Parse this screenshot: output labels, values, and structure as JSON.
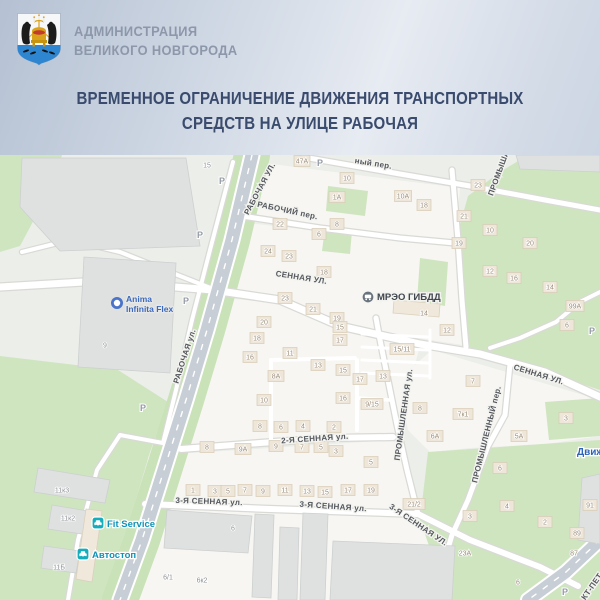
{
  "header": {
    "org_line1": "АДМИНИСТРАЦИЯ",
    "org_line2": "ВЕЛИКОГО НОВГОРОДА",
    "logo": "novgorod-coat-of-arms"
  },
  "title": {
    "line1": "ВРЕМЕННОЕ ОГРАНИЧЕНИЕ ДВИЖЕНИЯ ТРАНСПОРТНЫХ",
    "line2": "СРЕДСТВ НА УЛИЦЕ РАБОЧАЯ"
  },
  "map": {
    "colors": {
      "base": "#eceeea",
      "block": "#f7f6f2",
      "green": "#cfe5c0",
      "band": "#c9e2b7",
      "casing": "#d9dad6",
      "major": "#c7ced6",
      "bgray": "#dfe1e0",
      "bgstroke": "#ccd0cf",
      "bbeige": "#efe8db",
      "bbstroke": "#dbd0bd",
      "house": "#eee6d8",
      "housestroke": "#d8cbb6",
      "teal": "#15adbc",
      "accent_blue": "#2f63b5"
    },
    "blocks": [
      "240,160 460,188 455,243 238,218",
      "238,222 455,246 463,345 340,326 280,300 218,295",
      "216,298 280,302 340,328 420,346 395,438 183,450",
      "148,456 393,440 418,515 145,505",
      "432,350 600,400 600,436 546,444 470,448 430,452 408,430 398,380",
      "150,455 400,442 420,520 448,552 450,600 105,600"
    ],
    "greens": [
      "0,155 62,155 54,182 20,246 0,252",
      "528,155 600,155 600,390 552,374 505,360 468,348 460,300 455,243 468,196 500,172",
      "328,186 368,191 365,216 326,211",
      "325,228 352,231 350,254 322,251",
      "420,258 448,262 445,306 417,301",
      "0,356 118,370 168,402 150,452 106,600 0,600",
      "428,452 600,440 600,600 448,600 420,520",
      "545,402 600,398 600,436 549,440"
    ],
    "band": "252,155 232,240 207,330 186,400 164,470 142,540 120,600",
    "major": "252,155 232,240 207,330 186,400 164,470 142,540 120,600",
    "stp": "600,540 566,572 528,600",
    "roads": [
      {
        "p": "0,287 100,281 213,290 280,300 340,326 420,344 480,354 545,372 600,397",
        "w": 7,
        "t": "m"
      },
      {
        "p": "242,216 320,228 400,238 455,243",
        "w": 5,
        "t": "m"
      },
      {
        "p": "303,157 400,174 470,186 545,200 600,210",
        "w": 5,
        "t": "m"
      },
      {
        "p": "452,170 458,240 462,300 466,347",
        "w": 5,
        "t": "m"
      },
      {
        "p": "181,449 260,443 330,438 393,437",
        "w": 6,
        "t": "m"
      },
      {
        "p": "145,504 270,509 418,514 470,540 540,567 578,586",
        "w": 6,
        "t": "m"
      },
      {
        "p": "376,318 380,340 388,380 397,425 407,470 418,514",
        "w": 5,
        "t": "m"
      },
      {
        "p": "510,364 505,415 488,446 468,500 452,535 446,555",
        "w": 5,
        "t": "m"
      },
      {
        "p": "233,162 210,250 192,320 176,390 163,443",
        "w": 4,
        "t": "m"
      },
      {
        "p": "163,443 120,435 97,470 78,540 68,600",
        "w": 4,
        "t": "m"
      },
      {
        "p": "22,252 70,240 120,252 170,272 213,289",
        "w": 4,
        "t": "m"
      },
      {
        "p": "600,292 580,302 556,322 520,338 490,348",
        "w": 4,
        "t": "m"
      },
      {
        "p": "271,360 355,358",
        "w": 4,
        "t": "l"
      },
      {
        "p": "271,360 271,445",
        "w": 4,
        "t": "l"
      },
      {
        "p": "357,360 357,430",
        "w": 4,
        "t": "l"
      },
      {
        "p": "357,398 390,400",
        "w": 3.5,
        "t": "l"
      },
      {
        "p": "362,334 428,337",
        "w": 3,
        "t": "l"
      },
      {
        "p": "362,347 428,350",
        "w": 3,
        "t": "l"
      },
      {
        "p": "362,360 428,363",
        "w": 3,
        "t": "l"
      },
      {
        "p": "362,373 428,376",
        "w": 3,
        "t": "l"
      },
      {
        "p": "430,330 430,378",
        "w": 3,
        "t": "l"
      }
    ],
    "buildings": [
      {
        "p": "22,158 186,158 200,246 60,251 20,207",
        "f": "gr"
      },
      {
        "p": "84,257 176,263 170,373 78,367",
        "f": "gr"
      },
      {
        "p": "167,510 252,516 248,553 164,548",
        "f": "gr"
      },
      {
        "p": "255,514 274,515 271,598 252,597",
        "f": "gr"
      },
      {
        "p": "280,527 299,528 297,600 278,600",
        "f": "gr"
      },
      {
        "p": "303,513 328,514 325,600 300,600",
        "f": "gr"
      },
      {
        "p": "333,541 455,546 452,600 330,600",
        "f": "gr"
      },
      {
        "p": "38,468 110,480 105,503 34,492",
        "f": "gr"
      },
      {
        "p": "52,505 100,513 96,536 48,529",
        "f": "gr"
      },
      {
        "p": "44,546 80,551 76,573 41,568",
        "f": "gr"
      },
      {
        "p": "516,155 600,155 600,172 520,169",
        "f": "gr"
      },
      {
        "p": "582,478 600,474 600,544 578,540",
        "f": "gr"
      },
      {
        "p": "86,509 102,511 92,582 76,579",
        "f": "be"
      },
      {
        "p": "394,300 440,304 439,317 393,313",
        "f": "be"
      }
    ],
    "houses": [
      {
        "x": 207,
        "y": 165,
        "n": "15",
        "r": 0,
        "c": "b"
      },
      {
        "x": 302,
        "y": 161,
        "n": "47А",
        "w": 16
      },
      {
        "x": 347,
        "y": 178,
        "n": "10"
      },
      {
        "x": 337,
        "y": 197,
        "n": "1А",
        "w": 16
      },
      {
        "x": 403,
        "y": 196,
        "n": "10А",
        "w": 17
      },
      {
        "x": 424,
        "y": 205,
        "n": "18"
      },
      {
        "x": 478,
        "y": 185,
        "n": "23"
      },
      {
        "x": 464,
        "y": 216,
        "n": "21"
      },
      {
        "x": 490,
        "y": 230,
        "n": "10"
      },
      {
        "x": 459,
        "y": 243,
        "n": "19"
      },
      {
        "x": 530,
        "y": 243,
        "n": "20"
      },
      {
        "x": 490,
        "y": 271,
        "n": "12"
      },
      {
        "x": 514,
        "y": 278,
        "n": "16"
      },
      {
        "x": 550,
        "y": 287,
        "n": "14"
      },
      {
        "x": 575,
        "y": 306,
        "n": "99А",
        "w": 18
      },
      {
        "x": 567,
        "y": 325,
        "n": "6"
      },
      {
        "x": 280,
        "y": 224,
        "n": "22"
      },
      {
        "x": 337,
        "y": 224,
        "n": "8"
      },
      {
        "x": 319,
        "y": 234,
        "n": "6"
      },
      {
        "x": 268,
        "y": 251,
        "n": "24"
      },
      {
        "x": 289,
        "y": 256,
        "n": "23"
      },
      {
        "x": 324,
        "y": 272,
        "n": "18"
      },
      {
        "x": 424,
        "y": 313,
        "n": "14",
        "r": 0
      },
      {
        "x": 447,
        "y": 330,
        "n": "12"
      },
      {
        "x": 402,
        "y": 349,
        "n": "15/11",
        "w": 24
      },
      {
        "x": 285,
        "y": 298,
        "n": "23"
      },
      {
        "x": 313,
        "y": 309,
        "n": "21"
      },
      {
        "x": 337,
        "y": 318,
        "n": "19"
      },
      {
        "x": 264,
        "y": 322,
        "n": "20"
      },
      {
        "x": 257,
        "y": 338,
        "n": "18"
      },
      {
        "x": 340,
        "y": 327,
        "n": "15"
      },
      {
        "x": 340,
        "y": 340,
        "n": "17"
      },
      {
        "x": 290,
        "y": 353,
        "n": "11"
      },
      {
        "x": 250,
        "y": 357,
        "n": "16"
      },
      {
        "x": 318,
        "y": 365,
        "n": "13"
      },
      {
        "x": 343,
        "y": 370,
        "n": "15"
      },
      {
        "x": 276,
        "y": 376,
        "n": "8А",
        "w": 16
      },
      {
        "x": 360,
        "y": 379,
        "n": "17"
      },
      {
        "x": 383,
        "y": 376,
        "n": "13"
      },
      {
        "x": 264,
        "y": 400,
        "n": "10"
      },
      {
        "x": 343,
        "y": 398,
        "n": "16"
      },
      {
        "x": 372,
        "y": 404,
        "n": "9/15",
        "w": 22
      },
      {
        "x": 260,
        "y": 426,
        "n": "8"
      },
      {
        "x": 281,
        "y": 427,
        "n": "6"
      },
      {
        "x": 303,
        "y": 426,
        "n": "4"
      },
      {
        "x": 334,
        "y": 427,
        "n": "2"
      },
      {
        "x": 207,
        "y": 447,
        "n": "8"
      },
      {
        "x": 243,
        "y": 449,
        "n": "9А",
        "w": 16
      },
      {
        "x": 276,
        "y": 446,
        "n": "9"
      },
      {
        "x": 302,
        "y": 447,
        "n": "7"
      },
      {
        "x": 321,
        "y": 447,
        "n": "5"
      },
      {
        "x": 336,
        "y": 451,
        "n": "3"
      },
      {
        "x": 371,
        "y": 462,
        "n": "5"
      },
      {
        "x": 193,
        "y": 490,
        "n": "1"
      },
      {
        "x": 215,
        "y": 491,
        "n": "3"
      },
      {
        "x": 228,
        "y": 491,
        "n": "5"
      },
      {
        "x": 245,
        "y": 490,
        "n": "7"
      },
      {
        "x": 263,
        "y": 491,
        "n": "9"
      },
      {
        "x": 285,
        "y": 490,
        "n": "11"
      },
      {
        "x": 307,
        "y": 491,
        "n": "13"
      },
      {
        "x": 325,
        "y": 492,
        "n": "15"
      },
      {
        "x": 348,
        "y": 490,
        "n": "17"
      },
      {
        "x": 371,
        "y": 490,
        "n": "19"
      },
      {
        "x": 414,
        "y": 504,
        "n": "21/2",
        "w": 22
      },
      {
        "x": 473,
        "y": 381,
        "n": "7"
      },
      {
        "x": 420,
        "y": 408,
        "n": "8"
      },
      {
        "x": 463,
        "y": 414,
        "n": "7к1",
        "w": 20
      },
      {
        "x": 435,
        "y": 436,
        "n": "6А",
        "w": 16
      },
      {
        "x": 519,
        "y": 436,
        "n": "5А",
        "w": 16
      },
      {
        "x": 566,
        "y": 418,
        "n": "3"
      },
      {
        "x": 500,
        "y": 468,
        "n": "6"
      },
      {
        "x": 507,
        "y": 506,
        "n": "4"
      },
      {
        "x": 545,
        "y": 522,
        "n": "2"
      },
      {
        "x": 470,
        "y": 516,
        "n": "3"
      },
      {
        "x": 590,
        "y": 505,
        "n": "91"
      },
      {
        "x": 577,
        "y": 533,
        "n": "89"
      },
      {
        "x": 574,
        "y": 553,
        "n": "87",
        "r": 0
      },
      {
        "x": 465,
        "y": 553,
        "n": "23А",
        "r": 0,
        "w": 18
      },
      {
        "x": 518,
        "y": 582,
        "n": "6",
        "r": 0
      },
      {
        "x": 62,
        "y": 490,
        "n": "11к3",
        "r": 0,
        "c": "b",
        "w": 22
      },
      {
        "x": 68,
        "y": 518,
        "n": "11к2",
        "r": 0,
        "c": "b",
        "w": 22
      },
      {
        "x": 59,
        "y": 567,
        "n": "11Б",
        "r": 0,
        "c": "b",
        "w": 20
      },
      {
        "x": 168,
        "y": 577,
        "n": "6/1",
        "r": 0,
        "c": "b"
      },
      {
        "x": 202,
        "y": 580,
        "n": "6к2",
        "r": 0,
        "c": "b",
        "w": 20
      },
      {
        "x": 233,
        "y": 528,
        "n": "6",
        "r": 0,
        "c": "b"
      },
      {
        "x": 105,
        "y": 345,
        "n": "9",
        "r": 0,
        "c": "b"
      }
    ],
    "parkings": [
      [
        222,
        181
      ],
      [
        200,
        235
      ],
      [
        186,
        301
      ],
      [
        143,
        408
      ],
      [
        320,
        163
      ],
      [
        592,
        331
      ],
      [
        565,
        592
      ]
    ],
    "labels": [
      {
        "x": 262,
        "y": 190,
        "t": "РАБОЧАЯ УЛ.",
        "r": -62
      },
      {
        "x": 187,
        "y": 357,
        "t": "РАБОЧАЯ ул.",
        "r": -72
      },
      {
        "x": 287,
        "y": 213,
        "t": "РАБОЧИЙ пер.",
        "r": 12
      },
      {
        "x": 373,
        "y": 166,
        "t": "ный пер.",
        "r": 9
      },
      {
        "x": 301,
        "y": 280,
        "t": "СЕННАЯ УЛ.",
        "r": 9
      },
      {
        "x": 538,
        "y": 377,
        "t": "СЕННАЯ УЛ.",
        "r": 17
      },
      {
        "x": 315,
        "y": 441,
        "t": "2-Я СЕННАЯ ул.",
        "r": -4
      },
      {
        "x": 209,
        "y": 504,
        "t": "3-Я СЕННАЯ ул.",
        "r": 2
      },
      {
        "x": 333,
        "y": 509,
        "t": "3-Я СЕННАЯ ул.",
        "r": 4
      },
      {
        "x": 417,
        "y": 527,
        "t": "3-Я СЕННАЯ УЛ.",
        "r": 34
      },
      {
        "x": 501,
        "y": 174,
        "t": "ПРОМЫШЛ",
        "r": -70
      },
      {
        "x": 406,
        "y": 415,
        "t": "ПРОМЫШЛЕННАЯ ул.",
        "r": -82
      },
      {
        "x": 489,
        "y": 435,
        "t": "ПРОМЫШЛЕННЫЙ пер.",
        "r": -76
      },
      {
        "x": 594,
        "y": 588,
        "t": "КТ-ПЕТ",
        "r": -55
      }
    ],
    "pois": {
      "mreo": {
        "cx": 368,
        "cy": 297,
        "lx": 377,
        "ly": 300,
        "label": "МРЭО ГИБДД"
      },
      "anima": {
        "cx": 117,
        "cy": 303,
        "lx": 126,
        "line1": "Anima",
        "line2": "Infinita Flex"
      },
      "fit": {
        "x": 92,
        "y": 517,
        "lx": 107,
        "ly": 527,
        "label": "Fit Service"
      },
      "avtostop": {
        "x": 77,
        "y": 548,
        "lx": 92,
        "ly": 558,
        "label": "Автостоп"
      },
      "dvizhenie": {
        "lx": 577,
        "ly": 455,
        "label": "Движ"
      }
    }
  }
}
